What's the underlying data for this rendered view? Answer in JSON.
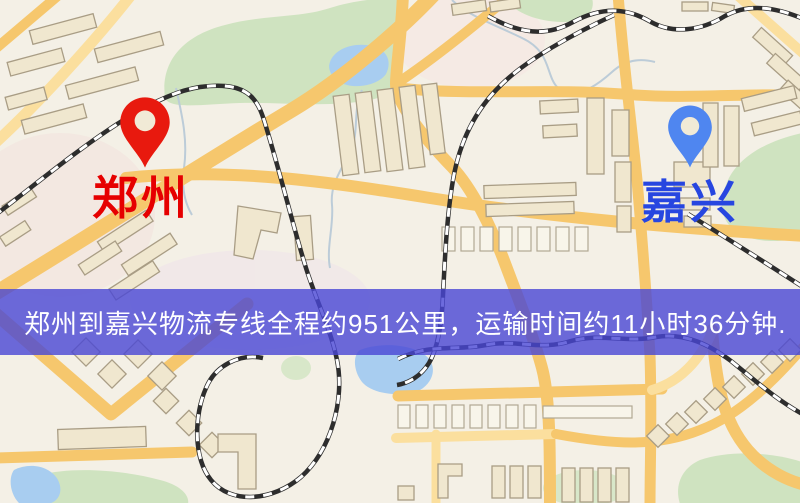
{
  "banner": {
    "text": "郑州到嘉兴物流专线全程约951公里，运输时间约11小时36分钟."
  },
  "origin": {
    "name": "郑州"
  },
  "destination": {
    "name": "嘉兴"
  },
  "colors": {
    "origin_pin": "#e8190e",
    "origin_label": "#e60000",
    "destination_pin": "#4f86f0",
    "destination_label": "#2746e0",
    "banner_bg": "rgba(73,70,212,0.8)",
    "banner_text": "#ffffff",
    "road": "#f6c76d",
    "park": "#cfe3c0",
    "water": "#a8cdf0",
    "map_background": "#f4f0e6"
  }
}
